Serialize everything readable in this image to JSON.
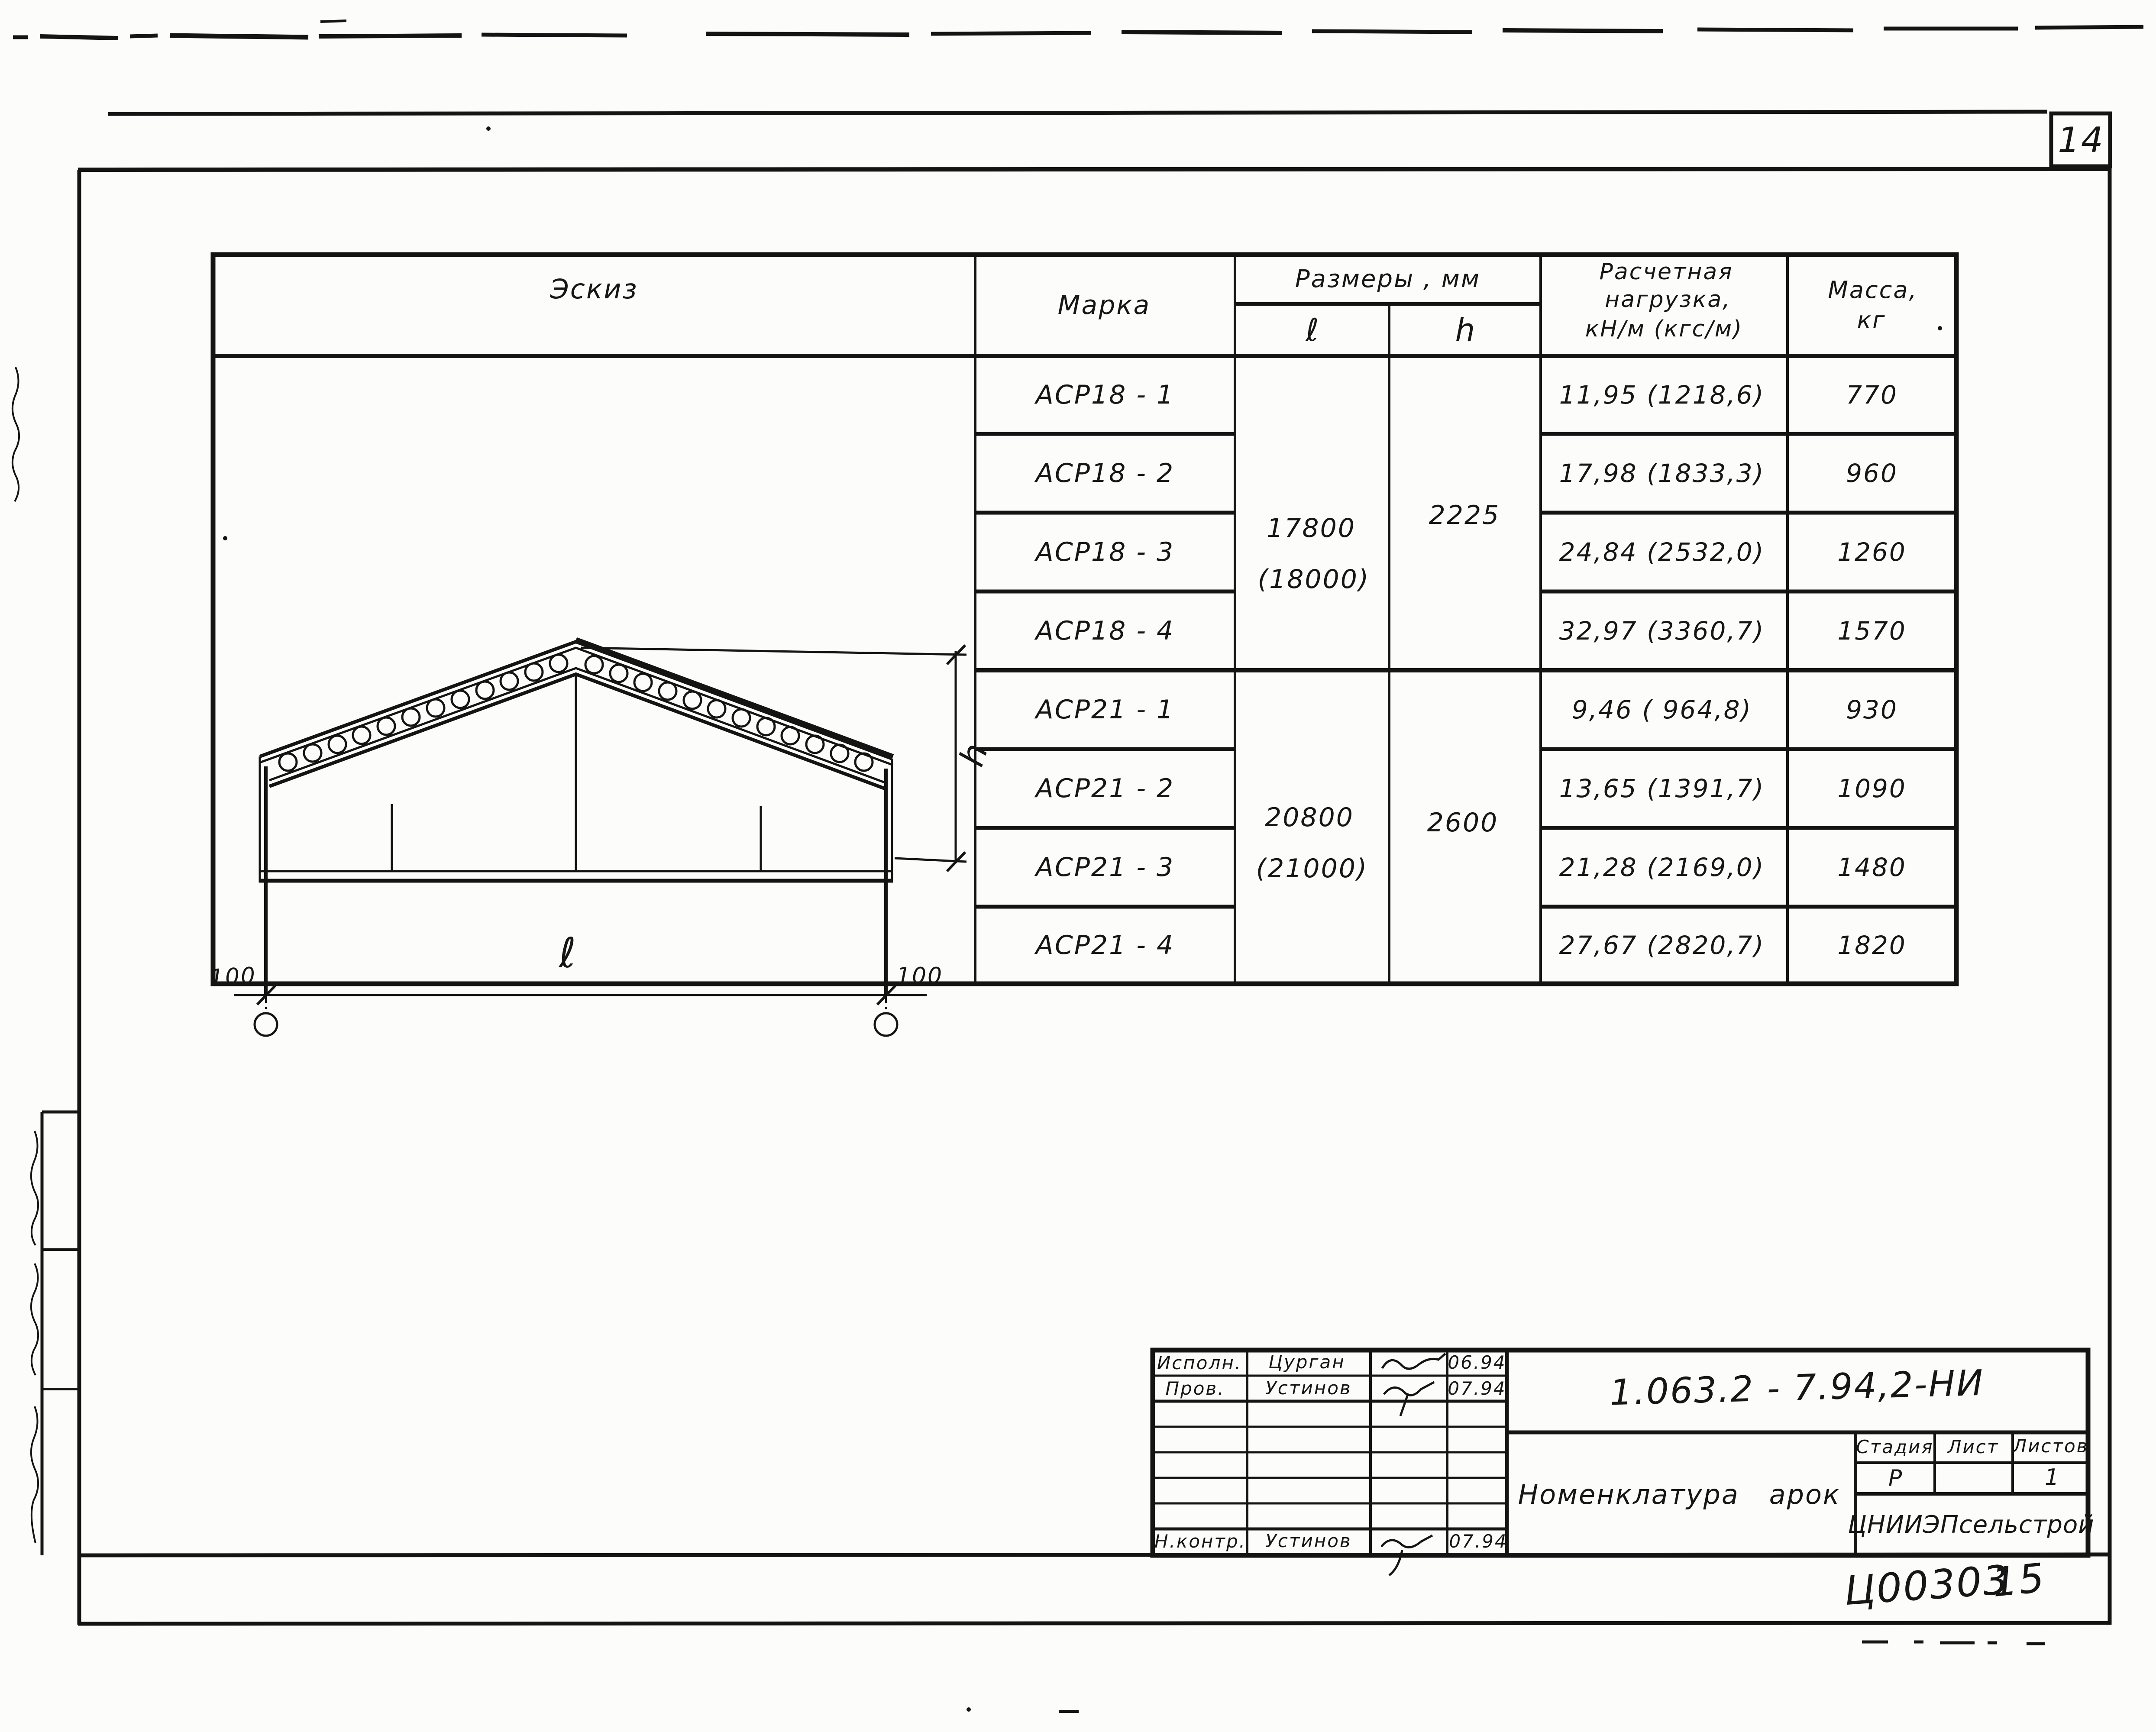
{
  "sheet": {
    "page_number": "14",
    "stamp_code_left": "Ц00303",
    "stamp_code_right": "15"
  },
  "table": {
    "header": {
      "sketch": "Эскиз",
      "mark": "Марка",
      "dimensions": "Размеры , мм",
      "dim_l": "ℓ",
      "dim_h": "h",
      "load": [
        "Расчетная",
        "нагрузка,",
        "кН/м (кгс/м)"
      ],
      "mass": [
        "Масса,",
        "кг"
      ]
    },
    "groups": [
      {
        "length": "17800",
        "length_alt": "(18000)",
        "height": "2225",
        "rows": [
          {
            "mark": "АСР18 - 1",
            "load": "11,95 (1218,6)",
            "mass": "770"
          },
          {
            "mark": "АСР18 - 2",
            "load": "17,98 (1833,3)",
            "mass": "960"
          },
          {
            "mark": "АСР18 - 3",
            "load": "24,84 (2532,0)",
            "mass": "1260"
          },
          {
            "mark": "АСР18 - 4",
            "load": "32,97 (3360,7)",
            "mass": "1570"
          }
        ]
      },
      {
        "length": "20800",
        "length_alt": "(21000)",
        "height": "2600",
        "rows": [
          {
            "mark": "АСР21 - 1",
            "load": "9,46 ( 964,8)",
            "mass": "930"
          },
          {
            "mark": "АСР21 - 2",
            "load": "13,65 (1391,7)",
            "mass": "1090"
          },
          {
            "mark": "АСР21 - 3",
            "load": "21,28 (2169,0)",
            "mass": "1480"
          },
          {
            "mark": "АСР21 - 4",
            "load": "27,67 (2820,7)",
            "mass": "1820"
          }
        ]
      }
    ]
  },
  "sketch": {
    "dim_length": "ℓ",
    "dim_height": "h",
    "offset_left": "100",
    "offset_right": "100"
  },
  "title_block": {
    "doc_number": "1.063.2 - 7.94,2-НИ",
    "title": "Номенклатура арок",
    "org": "ЦНИИЭПсельстрой",
    "stage_label": "Стадия",
    "sheet_label": "Лист",
    "sheets_label": "Листов",
    "stage": "Р",
    "sheet": "",
    "sheets": "1",
    "signatures": [
      {
        "role": "Исполн.",
        "name": "Цурган",
        "date": "06.94"
      },
      {
        "role": "Пров.",
        "name": "Устинов",
        "date": "07.94"
      },
      {
        "role": "Н.контр.",
        "name": "Устинов",
        "date": "07.94"
      }
    ]
  }
}
